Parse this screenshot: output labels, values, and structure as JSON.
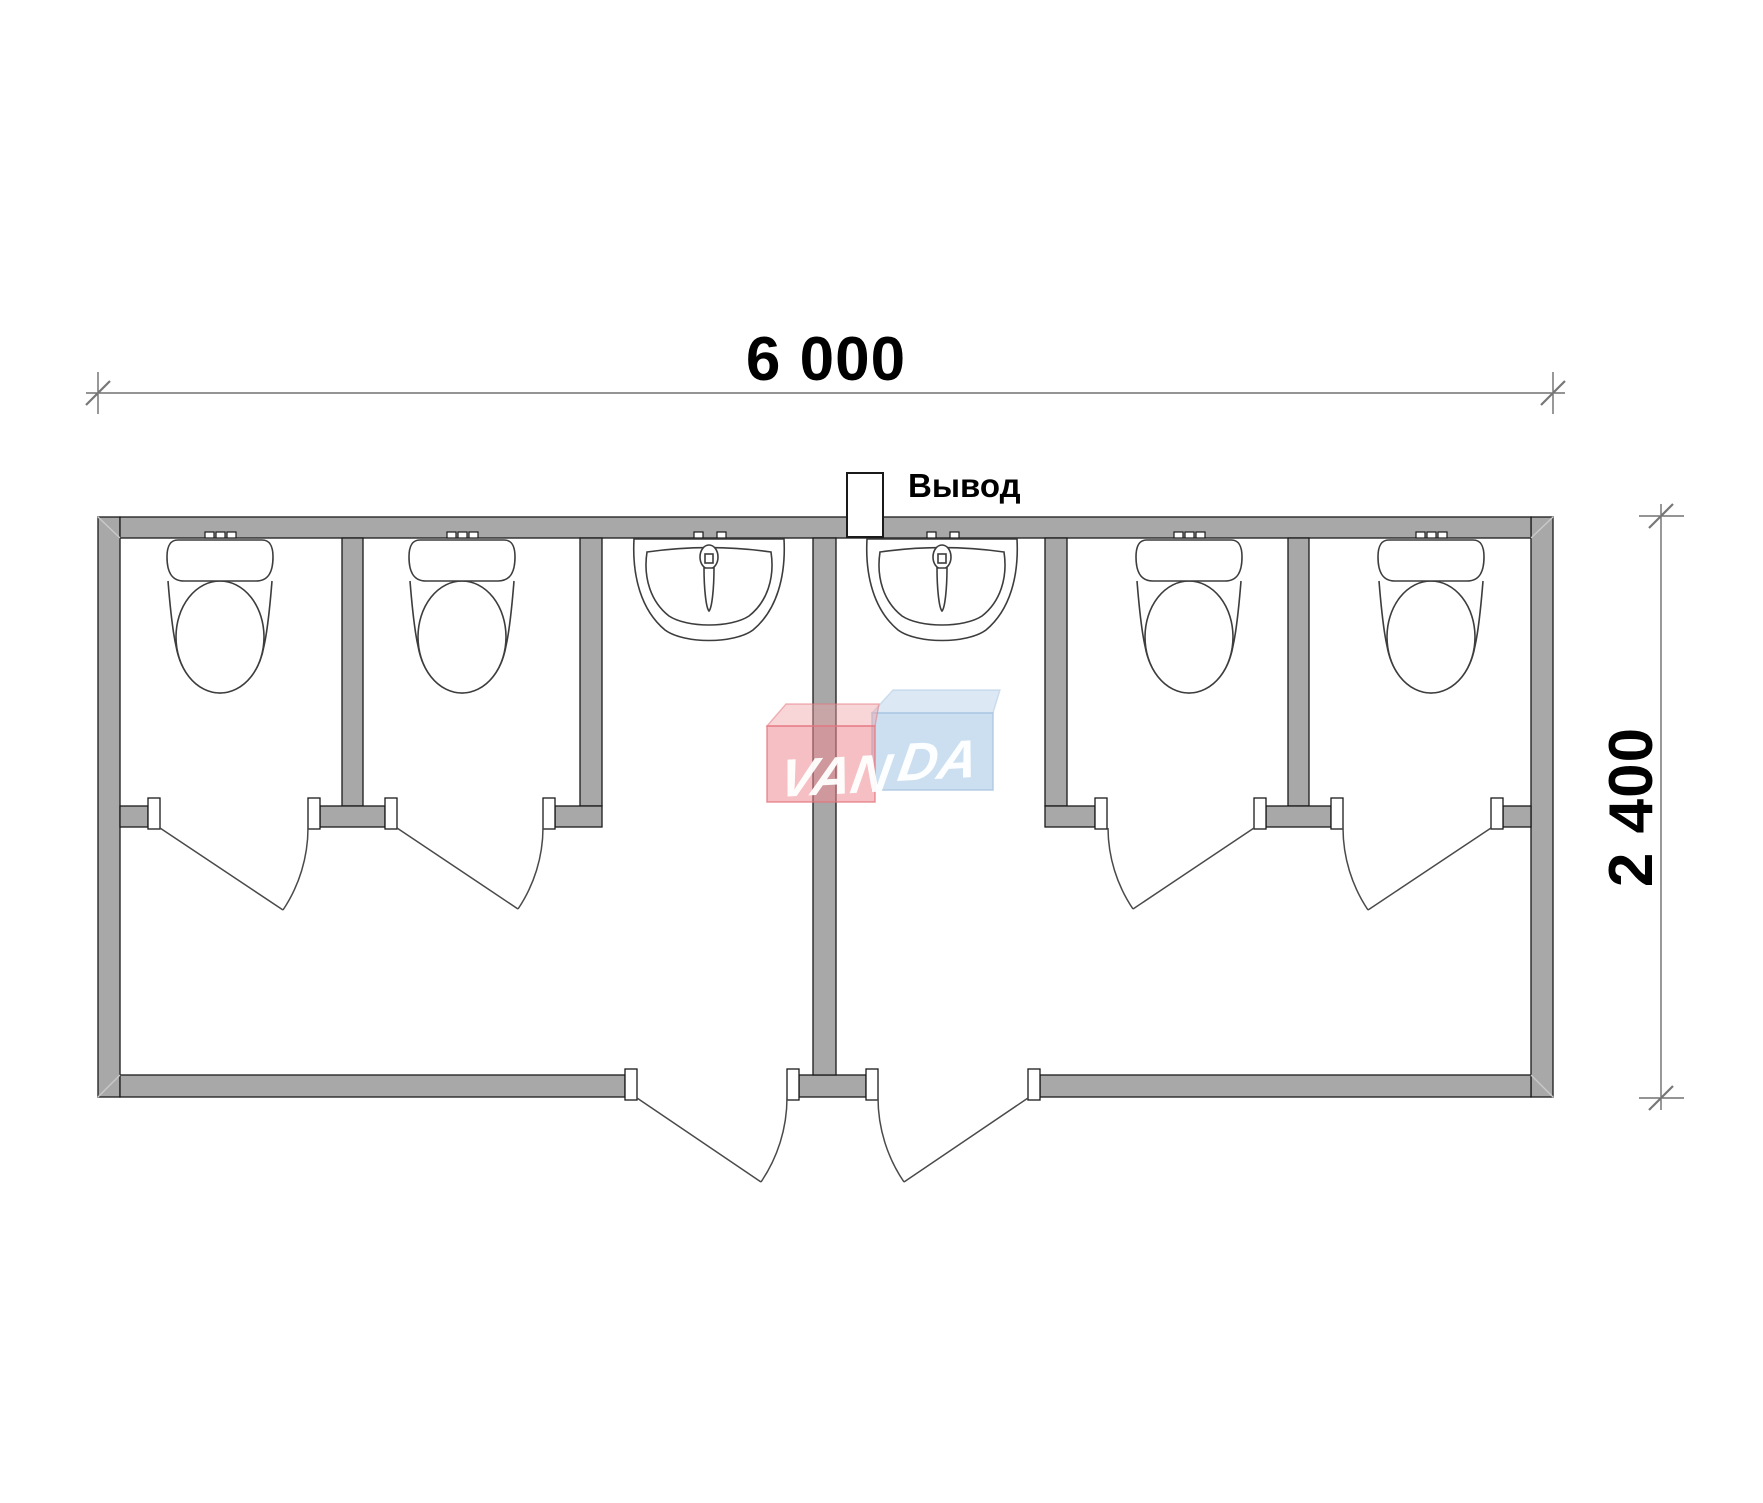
{
  "page": {
    "background": "#ffffff",
    "type": "sanitary-container-floor-plan"
  },
  "dimensions": {
    "width": {
      "label": "6 000"
    },
    "height": {
      "label": "2 400"
    }
  },
  "labels": {
    "outlet": "Вывод"
  },
  "watermark": {
    "full": "VANDA",
    "left_text": "VAN",
    "right_text": "DA"
  },
  "plan": {
    "toilet_stalls": 4,
    "toilets": 4,
    "washbasins": 2,
    "entrance_doors": 2,
    "stall_doors": 4
  },
  "colors": {
    "wall_fill": "#a8a8a8",
    "wall_outline": "#1a1a1a",
    "fixture_line": "#3d3d3d",
    "door_line": "#4a4a4a",
    "dimension_line": "#555555",
    "text": "#000000",
    "logo_red_fill": "#ed8b92",
    "logo_red_border": "#e4737d",
    "logo_red_flap": "#f0a4a9",
    "logo_blue_fill": "#99bfe1",
    "logo_blue_border": "#a9c6e2",
    "logo_blue_flap": "#a7c8e6",
    "logo_text": "#ffffff"
  }
}
